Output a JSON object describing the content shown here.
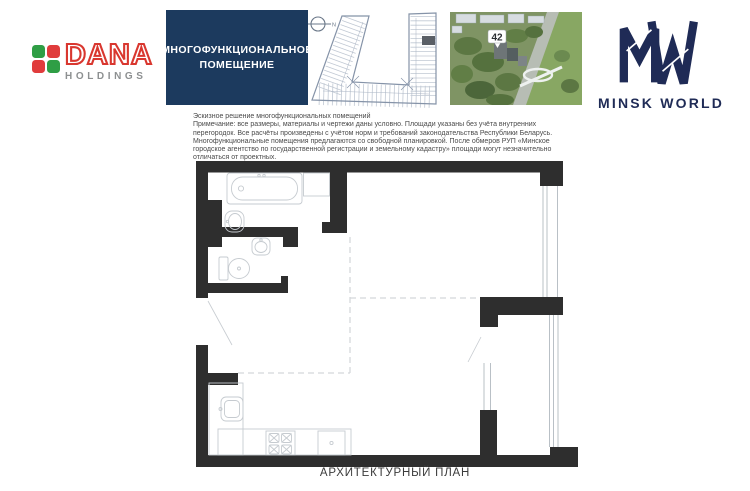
{
  "page": {
    "caption": "АРХИТЕКТУРНЫЙ ПЛАН"
  },
  "header": {
    "dana": {
      "brand": "DANA",
      "subbrand": "HOLDINGS",
      "brand_color": "#d9372f",
      "subbrand_color": "#8d9091",
      "square_colors": {
        "top_left": "#2f9e45",
        "top_right": "#e03c3c",
        "bottom_left": "#e03c3c",
        "bottom_right": "#2f9e45"
      }
    },
    "premises_box": {
      "line1": "МНОГОФУНКЦИОНАЛЬНОЕ",
      "line2": "ПОМЕЩЕНИЕ",
      "bg_color": "#1c3a5e",
      "text_color": "#ffffff"
    },
    "site_plan": {
      "north_label": "N",
      "highlight_color": "#5a5f66"
    },
    "aerial": {
      "building_number": "42"
    },
    "minsk_world": {
      "wordmark": "MINSK WORLD",
      "color": "#1f2b56"
    }
  },
  "notes": {
    "title": "Эскизное решение многофункциональных помещений",
    "body": "Примечание: все размеры, материалы и чертежи даны условно. Площади указаны без учёта внутренних перегородок. Все расчёты произведены с учётом норм и требований законодательства Республики Беларусь. Многофункциональные помещения предлагаются со свободной планировкой. После обмеров РУП «Минское городское агентство по государственной регистрации и земельному кадастру» площади могут незначительно отличаться от проектных."
  },
  "plan": {
    "wall_color": "#2e2e2e",
    "fixture_color": "#c6cbd0",
    "dash_color": "#d3d6d9"
  }
}
